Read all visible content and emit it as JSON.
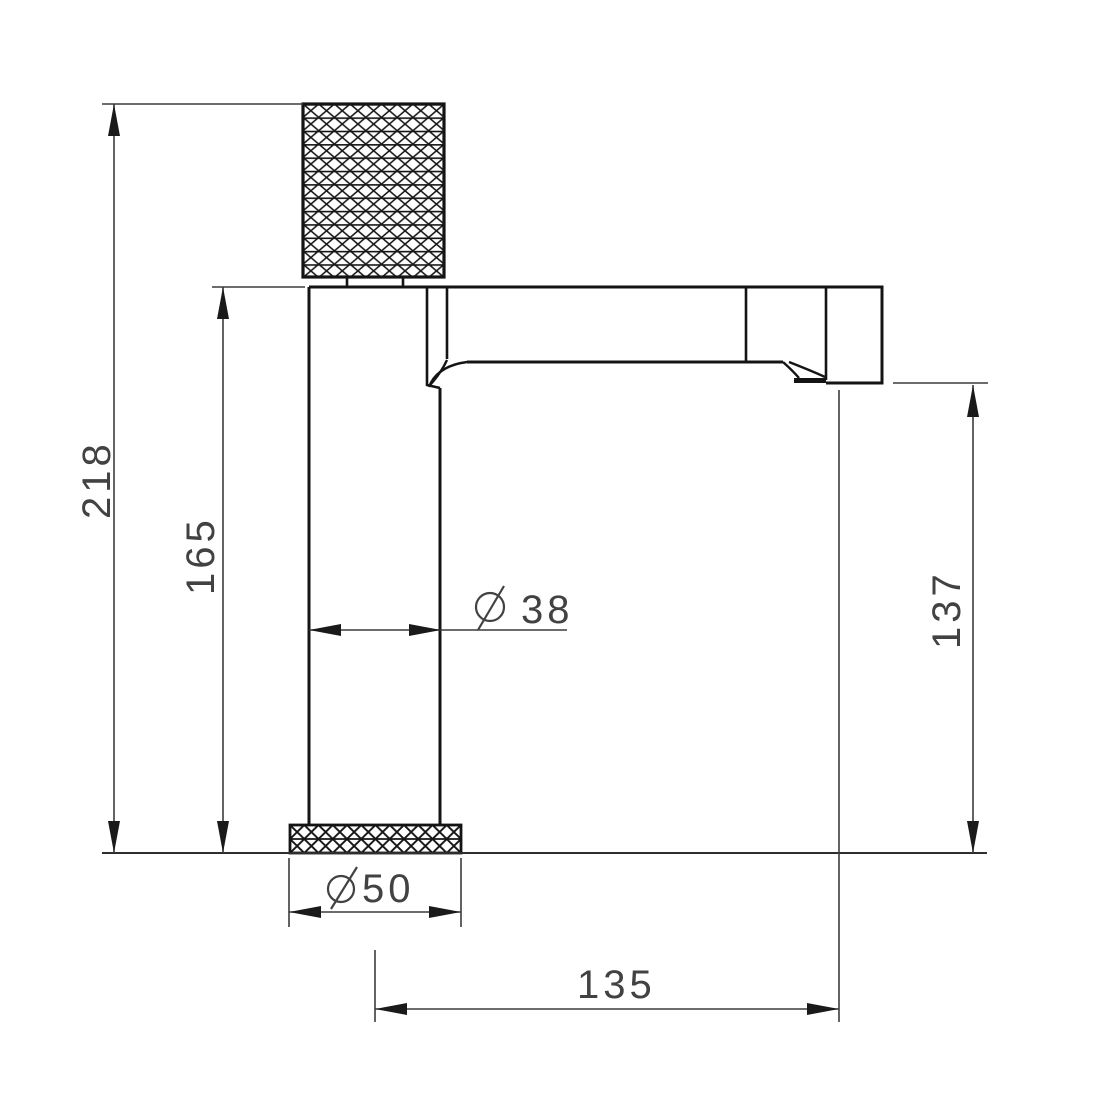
{
  "drawing": {
    "colors": {
      "background": "#ffffff",
      "object_line": "#141414",
      "dimension_line": "#3c3c3c",
      "text": "#424242"
    },
    "dimensions": {
      "overall_height": {
        "value": "218"
      },
      "body_height": {
        "value": "165"
      },
      "outlet_height": {
        "value": "137"
      },
      "body_diameter": {
        "symbol": "Ø",
        "value": "38",
        "label": "Ø 38"
      },
      "base_diameter": {
        "symbol": "Ø",
        "value": "50",
        "label": "Ø 50"
      },
      "spout_reach": {
        "value": "135"
      }
    }
  }
}
